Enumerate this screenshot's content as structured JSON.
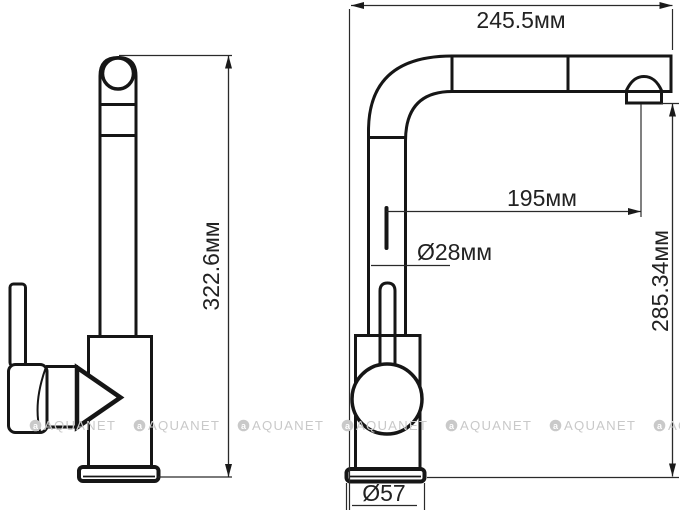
{
  "title": "faucet-technical-drawing",
  "colors": {
    "background": "#ffffff",
    "line": "#161616",
    "text": "#222222",
    "watermark": "#c9c9c9"
  },
  "dimensions": {
    "overall_width": "245.5мм",
    "overall_height": "322.6мм",
    "spout_reach": "195мм",
    "spout_diameter": "Ø28мм",
    "outlet_height": "285.34мм",
    "base_diameter": "Ø57"
  },
  "watermark": {
    "logo_letter": "a",
    "text": "AQUANET"
  }
}
